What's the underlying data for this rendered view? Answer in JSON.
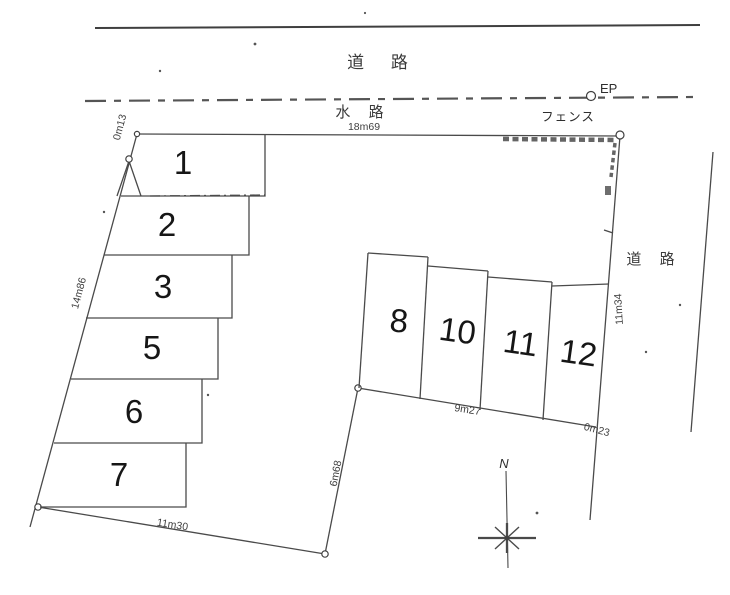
{
  "labels": {
    "road_top": "道 路",
    "waterway": "水 路",
    "fence": "フェンス",
    "ep": "EP",
    "road_right": "道 路",
    "north": "N"
  },
  "measurements": {
    "top_edge": "18m69",
    "left_top": "0m13",
    "left_side": "14m86",
    "bottom_edge": "11m30",
    "inner_vertical": "6m68",
    "inner_bottom": "9m27",
    "right_bottom": "0m23",
    "right_side": "11m34"
  },
  "plots": {
    "left": [
      {
        "number": "1"
      },
      {
        "number": "2"
      },
      {
        "number": "3"
      },
      {
        "number": "5"
      },
      {
        "number": "6"
      },
      {
        "number": "7"
      }
    ],
    "right": [
      {
        "number": "8"
      },
      {
        "number": "10"
      },
      {
        "number": "11"
      },
      {
        "number": "12"
      }
    ]
  },
  "colors": {
    "line": "#4a4a4a",
    "text": "#2e2e2e",
    "background": "#ffffff"
  }
}
